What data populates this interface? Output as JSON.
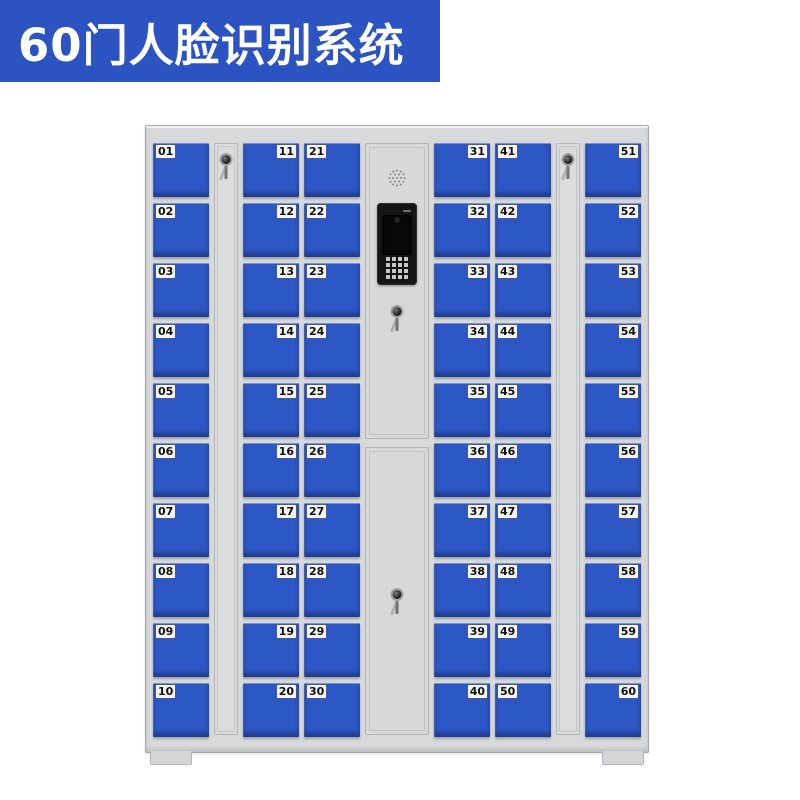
{
  "banner": {
    "title": "60门人脸识别系统"
  },
  "cabinet": {
    "columns": [
      {
        "type": "doors",
        "label_side": "left",
        "doors": [
          "01",
          "02",
          "03",
          "04",
          "05",
          "06",
          "07",
          "08",
          "09",
          "10"
        ]
      },
      {
        "type": "lock_strip"
      },
      {
        "type": "doors",
        "label_side": "right",
        "doors": [
          "11",
          "12",
          "13",
          "14",
          "15",
          "16",
          "17",
          "18",
          "19",
          "20"
        ]
      },
      {
        "type": "doors",
        "label_side": "left",
        "doors": [
          "21",
          "22",
          "23",
          "24",
          "25",
          "26",
          "27",
          "28",
          "29",
          "30"
        ]
      },
      {
        "type": "control",
        "parts": [
          "speaker-grille-icon",
          "face-recognition-terminal",
          "key-lock",
          "key-lock"
        ]
      },
      {
        "type": "doors",
        "label_side": "right",
        "doors": [
          "31",
          "32",
          "33",
          "34",
          "35",
          "36",
          "37",
          "38",
          "39",
          "40"
        ]
      },
      {
        "type": "doors",
        "label_side": "left",
        "doors": [
          "41",
          "42",
          "43",
          "44",
          "45",
          "46",
          "47",
          "48",
          "49",
          "50"
        ]
      },
      {
        "type": "lock_strip"
      },
      {
        "type": "doors",
        "label_side": "right",
        "doors": [
          "51",
          "52",
          "53",
          "54",
          "55",
          "56",
          "57",
          "58",
          "59",
          "60"
        ]
      }
    ]
  },
  "colors": {
    "banner_bg": "#2b53c1",
    "banner_text": "#ffffff",
    "door_blue": "#2d57c4",
    "cabinet_grey": "#d7d9da",
    "device_black": "#141517",
    "label_bg": "#f5f6f3"
  }
}
